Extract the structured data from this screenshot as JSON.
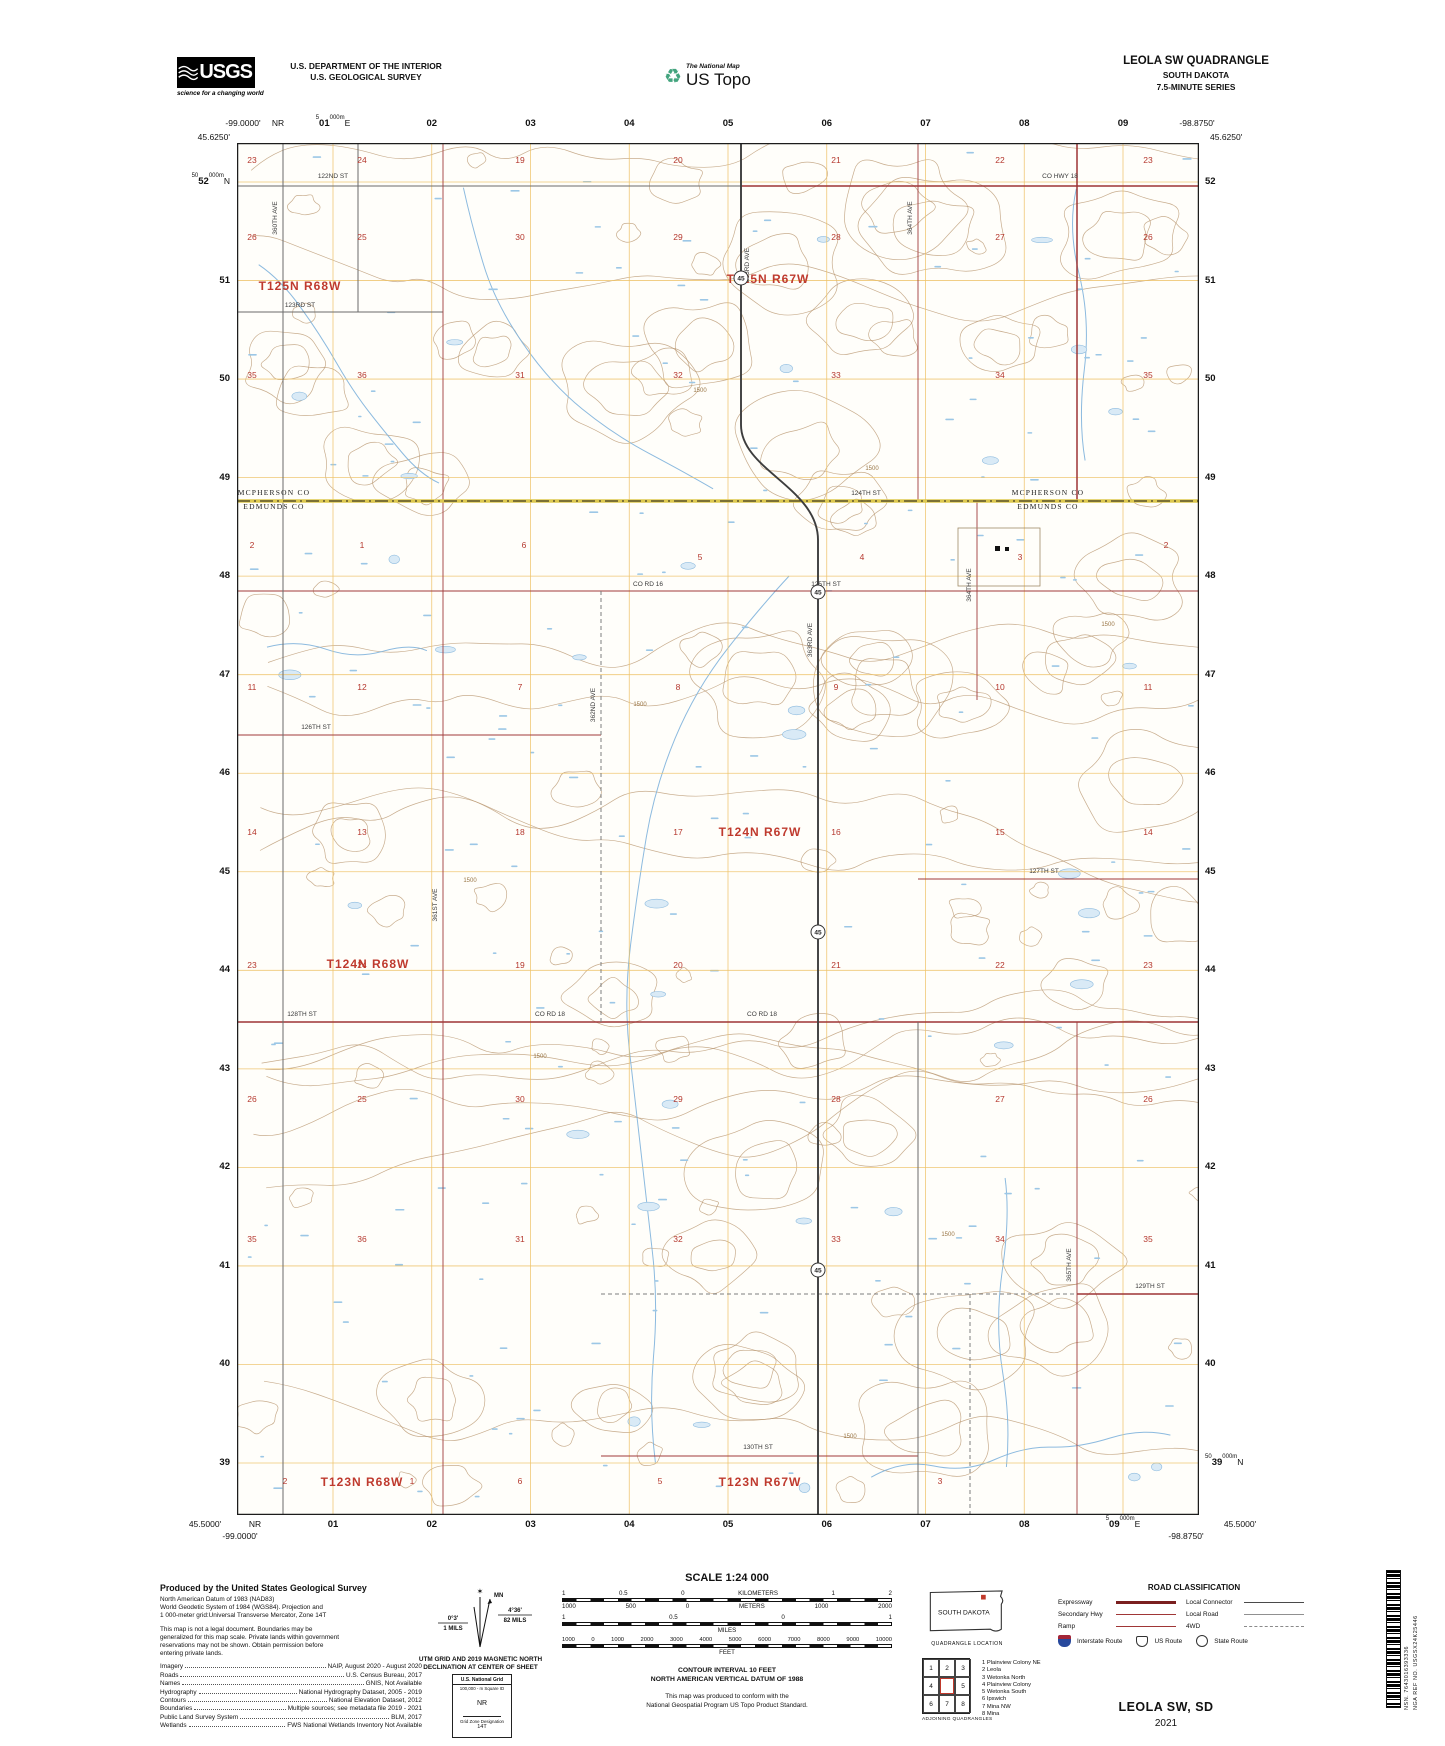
{
  "header": {
    "agency": "USGS",
    "tagline": "science for a changing world",
    "dept1": "U.S. DEPARTMENT OF THE INTERIOR",
    "dept2": "U.S. GEOLOGICAL SURVEY",
    "tnm": "The National Map",
    "ustopo": "US Topo",
    "quad": "LEOLA SW QUADRANGLE",
    "state": "SOUTH DAKOTA",
    "series": "7.5-MINUTE SERIES"
  },
  "map": {
    "corners": {
      "top_lat": "45.6250'",
      "bot_lat": "45.5000'",
      "west_lon": "-99.0000'",
      "east_lon": "-98.8750'",
      "nr": "NR"
    },
    "top_grid": [
      {
        "p": "5",
        "m": "01",
        "s": "000m",
        "x": "E"
      },
      "02",
      "03",
      "04",
      "05",
      "06",
      "07",
      "08",
      "09"
    ],
    "bottom_grid": [
      "01",
      "02",
      "03",
      "04",
      "05",
      "06",
      "07",
      "08",
      {
        "p": "5",
        "m": "09",
        "s": "000m",
        "x": "E"
      }
    ],
    "left_grid": [
      {
        "p": "50",
        "m": "52",
        "s": "000m",
        "x": "N"
      },
      "51",
      "50",
      "49",
      "48",
      "47",
      "46",
      "45",
      "44",
      "43",
      "42",
      "41",
      "40",
      "39"
    ],
    "right_grid": [
      "52",
      "51",
      "50",
      "49",
      "48",
      "47",
      "46",
      "45",
      "44",
      "43",
      "42",
      "41",
      "40",
      {
        "p": "50",
        "m": "39",
        "s": "000m",
        "x": "N"
      }
    ],
    "townships": [
      [
        "T125N R68W",
        300,
        290
      ],
      [
        "T125N R67W",
        768,
        283
      ],
      [
        "T124N R68W",
        368,
        968
      ],
      [
        "T124N R67W",
        760,
        836
      ],
      [
        "T123N R68W",
        362,
        1486
      ],
      [
        "T123N R67W",
        760,
        1486
      ]
    ],
    "counties": [
      [
        "MCPHERSON CO",
        274,
        495
      ],
      [
        "EDMUNDS CO",
        274,
        509
      ],
      [
        "MCPHERSON CO",
        1048,
        495
      ],
      [
        "EDMUNDS CO",
        1048,
        509
      ]
    ],
    "sections": [
      [
        23,
        252,
        163
      ],
      [
        24,
        362,
        163
      ],
      [
        19,
        520,
        163
      ],
      [
        20,
        678,
        163
      ],
      [
        21,
        836,
        163
      ],
      [
        22,
        1000,
        163
      ],
      [
        23,
        1148,
        163
      ],
      [
        26,
        252,
        240
      ],
      [
        25,
        362,
        240
      ],
      [
        30,
        520,
        240
      ],
      [
        29,
        678,
        240
      ],
      [
        28,
        836,
        240
      ],
      [
        27,
        1000,
        240
      ],
      [
        26,
        1148,
        240
      ],
      [
        35,
        252,
        378
      ],
      [
        36,
        362,
        378
      ],
      [
        31,
        520,
        378
      ],
      [
        32,
        678,
        378
      ],
      [
        33,
        836,
        378
      ],
      [
        34,
        1000,
        378
      ],
      [
        35,
        1148,
        378
      ],
      [
        2,
        252,
        548
      ],
      [
        1,
        362,
        548
      ],
      [
        6,
        524,
        548
      ],
      [
        5,
        700,
        560
      ],
      [
        4,
        862,
        560
      ],
      [
        3,
        1020,
        560
      ],
      [
        2,
        1166,
        548
      ],
      [
        11,
        252,
        690
      ],
      [
        12,
        362,
        690
      ],
      [
        7,
        520,
        690
      ],
      [
        8,
        678,
        690
      ],
      [
        9,
        836,
        690
      ],
      [
        10,
        1000,
        690
      ],
      [
        11,
        1148,
        690
      ],
      [
        14,
        252,
        835
      ],
      [
        13,
        362,
        835
      ],
      [
        18,
        520,
        835
      ],
      [
        17,
        678,
        835
      ],
      [
        16,
        836,
        835
      ],
      [
        15,
        1000,
        835
      ],
      [
        14,
        1148,
        835
      ],
      [
        23,
        252,
        968
      ],
      [
        24,
        362,
        968
      ],
      [
        19,
        520,
        968
      ],
      [
        20,
        678,
        968
      ],
      [
        21,
        836,
        968
      ],
      [
        22,
        1000,
        968
      ],
      [
        23,
        1148,
        968
      ],
      [
        26,
        252,
        1102
      ],
      [
        25,
        362,
        1102
      ],
      [
        30,
        520,
        1102
      ],
      [
        29,
        678,
        1102
      ],
      [
        28,
        836,
        1102
      ],
      [
        27,
        1000,
        1102
      ],
      [
        26,
        1148,
        1102
      ],
      [
        35,
        252,
        1242
      ],
      [
        36,
        362,
        1242
      ],
      [
        31,
        520,
        1242
      ],
      [
        32,
        678,
        1242
      ],
      [
        33,
        836,
        1242
      ],
      [
        34,
        1000,
        1242
      ],
      [
        35,
        1148,
        1242
      ],
      [
        2,
        285,
        1484
      ],
      [
        1,
        412,
        1484
      ],
      [
        6,
        520,
        1484
      ],
      [
        5,
        660,
        1484
      ],
      [
        3,
        940,
        1484
      ]
    ],
    "road_labels": [
      [
        "122ND ST",
        333,
        178,
        0
      ],
      [
        "CO HWY 18",
        1060,
        178,
        0
      ],
      [
        "123RD ST",
        300,
        307,
        0
      ],
      [
        "124TH ST",
        866,
        495,
        0
      ],
      [
        "CO RD 16",
        648,
        586,
        0
      ],
      [
        "125TH ST",
        826,
        586,
        0
      ],
      [
        "126TH ST",
        316,
        729,
        0
      ],
      [
        "127TH ST",
        1044,
        873,
        0
      ],
      [
        "128TH ST",
        302,
        1016,
        0
      ],
      [
        "CO RD 18",
        550,
        1016,
        0
      ],
      [
        "CO RD 18",
        762,
        1016,
        0
      ],
      [
        "129TH ST",
        1150,
        1288,
        0
      ],
      [
        "130TH ST",
        758,
        1449,
        0
      ],
      [
        "360TH AVE",
        277,
        218,
        -90
      ],
      [
        "361ST AVE",
        437,
        905,
        -90
      ],
      [
        "362ND AVE",
        595,
        705,
        -90
      ],
      [
        "363RD AVE",
        749,
        265,
        -90
      ],
      [
        "363RD AVE",
        812,
        640,
        -90
      ],
      [
        "364TH AVE",
        912,
        218,
        -90
      ],
      [
        "364TH AVE",
        971,
        585,
        -90
      ],
      [
        "365TH AVE",
        1071,
        1265,
        -90
      ]
    ],
    "shield_num": "45",
    "shields": [
      [
        741,
        278
      ],
      [
        818,
        592
      ],
      [
        818,
        932
      ],
      [
        818,
        1270
      ]
    ],
    "contour_labels": [
      [
        "1500",
        872,
        470
      ],
      [
        "1500",
        640,
        706
      ],
      [
        "1500",
        540,
        1058
      ],
      [
        "1500",
        948,
        1236
      ],
      [
        "1500",
        700,
        392
      ],
      [
        "1500",
        1108,
        626
      ],
      [
        "1500",
        470,
        882
      ],
      [
        "1500",
        850,
        1438
      ]
    ]
  },
  "footer": {
    "credits": {
      "title": "Produced by the United States Geological Survey",
      "datum": [
        "North American Datum of 1983 (NAD83)",
        "World Geodetic System of 1984 (WGS84).  Projection and",
        "1 000-meter grid:Universal Transverse Mercator, Zone 14T"
      ],
      "legal": [
        "This map is not a legal document. Boundaries may be",
        "generalized for this map scale. Private lands within government",
        "reservations may not be shown. Obtain permission before",
        "entering private lands."
      ],
      "sources": [
        [
          "Imagery",
          "NAIP, August 2020 - August 2020"
        ],
        [
          "Roads",
          "U.S. Census Bureau, 2017"
        ],
        [
          "Names",
          "GNIS, Not Available"
        ],
        [
          "Hydrography",
          "National Hydrography Dataset, 2005 - 2019"
        ],
        [
          "Contours",
          "National Elevation Dataset, 2012"
        ],
        [
          "Boundaries",
          "Multiple sources; see metadata file 2019 - 2021"
        ],
        [
          "Public Land Survey System",
          "BLM, 2017"
        ],
        [
          "Wetlands",
          "FWS National Wetlands Inventory Not Available"
        ]
      ]
    },
    "declination": {
      "mn": "MN",
      "gn_deg": "0°3'",
      "gn_mils": "1 MILS",
      "mn_deg": "4°36'",
      "mn_mils": "82 MILS",
      "caption1": "UTM GRID AND 2019 MAGNETIC NORTH",
      "caption2": "DECLINATION AT CENTER OF SHEET",
      "grid_box": {
        "title": "U.S. National Grid",
        "sq_label": "100,000 - m Square ID",
        "square": "NR",
        "zone_label": "Grid Zone Designation",
        "zone": "14T"
      }
    },
    "scale": {
      "title": "SCALE 1:24 000",
      "km_labels": [
        "1",
        "0.5",
        "0",
        "KILOMETERS",
        "1",
        "2"
      ],
      "m_labels": [
        "1000",
        "500",
        "0",
        "METERS",
        "1000",
        "2000"
      ],
      "mi_labels": [
        "1",
        "0.5",
        "0",
        "1"
      ],
      "mi_unit": "MILES",
      "ft_labels": [
        "1000",
        "0",
        "1000",
        "2000",
        "3000",
        "4000",
        "5000",
        "6000",
        "7000",
        "8000",
        "9000",
        "10000"
      ],
      "ft_unit": "FEET",
      "contour1": "CONTOUR INTERVAL 10 FEET",
      "contour2": "NORTH AMERICAN VERTICAL DATUM OF 1988",
      "conform1": "This map was produced to conform with the",
      "conform2": "National Geospatial Program US Topo Product Standard."
    },
    "location": {
      "state": "SOUTH DAKOTA",
      "caption": "QUADRANGLE LOCATION"
    },
    "road_class": {
      "title": "ROAD CLASSIFICATION",
      "left": [
        [
          "Expressway",
          "l-expwy"
        ],
        [
          "Secondary Hwy",
          "l-sec"
        ],
        [
          "Ramp",
          "l-ramp"
        ]
      ],
      "right": [
        [
          "Local Connector",
          "l-conn"
        ],
        [
          "Local Road",
          "l-locr"
        ],
        [
          "4WD",
          "l-4wd"
        ]
      ],
      "shields": [
        [
          "Interstate Route",
          "sh-int"
        ],
        [
          "US Route",
          "sh-us"
        ],
        [
          "State Route",
          "sh-st"
        ]
      ]
    },
    "adjoining": {
      "cells": [
        "1",
        "2",
        "3",
        "4",
        "5",
        "6",
        "7",
        "8"
      ],
      "caption": "ADJOINING QUADRANGLES",
      "list": [
        "1 Plainview Colony NE",
        "2 Leola",
        "3 Wetonka North",
        "4 Plainview Colony",
        "5 Wetonka South",
        "6 Ipswich",
        "7 Mina NW",
        "8 Mina"
      ]
    },
    "sheet": {
      "name": "LEOLA SW, SD",
      "year": "2021"
    },
    "barcode": {
      "nsn": "NSN. 7643016393336",
      "nga": "NGA REF NO. USGSX24K25446"
    }
  }
}
